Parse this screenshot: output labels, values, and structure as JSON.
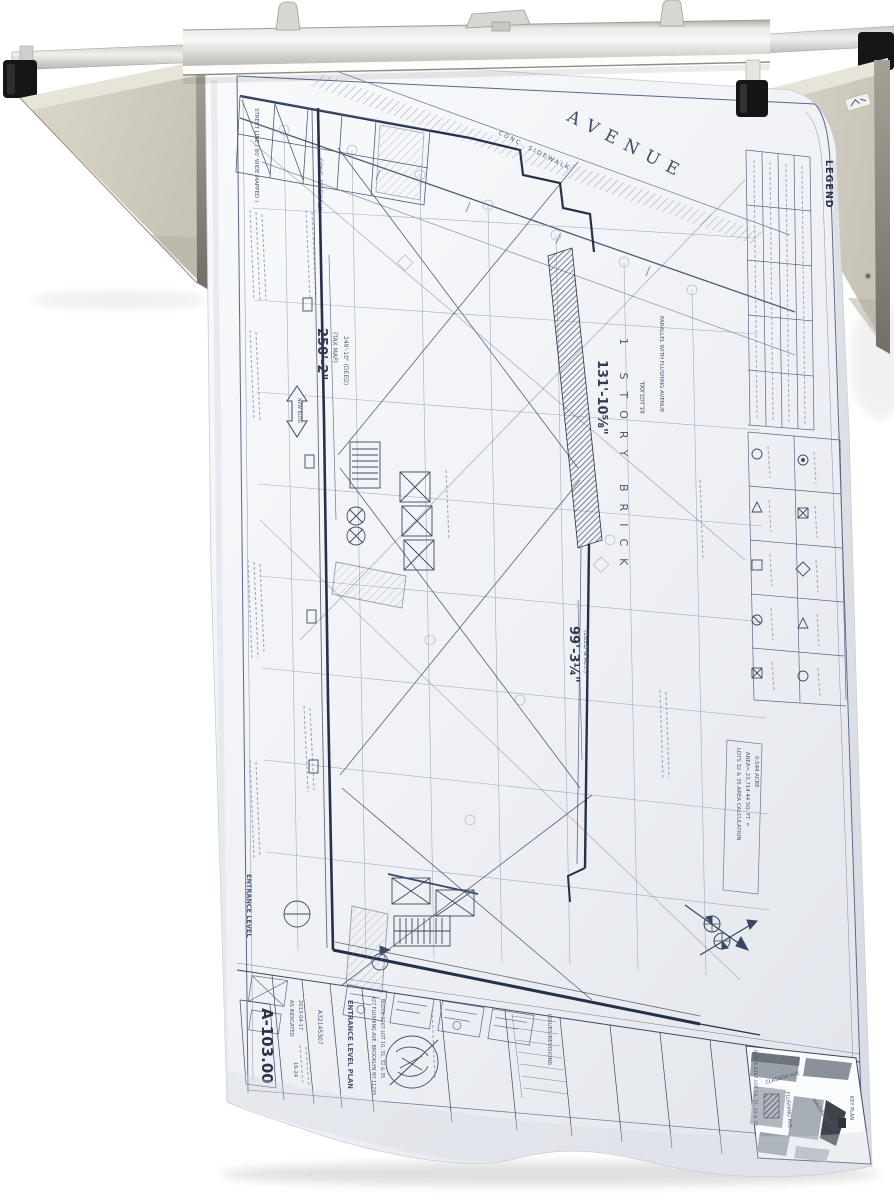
{
  "scene": {
    "background": "#ffffff"
  },
  "rack": {
    "name": "drop-lift-blueprint-wall-rack",
    "colors": {
      "bracket": "#cdc9bc",
      "rail": "#d9d9d6",
      "end_caps": "#161616",
      "clamp_bar": "#e8e8e5"
    }
  },
  "blueprint": {
    "paper_color": "#f2f4f7",
    "ink_color": "#425070",
    "street": {
      "avenue": "AVENUE",
      "conc_sidewalk": "CONC. SIDEWALK",
      "street_line": "STREET LINE ( 80' WIDE MAPPED )"
    },
    "dimensions": {
      "d250": "250'-2\"",
      "d250_note": "(TAX MAP)",
      "d249": "249'-10\" (DEED)",
      "d131": "131'-10⅝\"",
      "d99": "99'-3¼\"",
      "d99_note": "(DEED & ACT.)"
    },
    "labels": {
      "parallel_note": "PARALLEL WITH FLUSHING AVENUE",
      "tax_lot": "TAX LOT 14",
      "story_brick": "1 STORY BRICK",
      "new_bldg": "NEW BLDG",
      "entrance_level": "ENTRANCE LEVEL"
    },
    "legend": {
      "title": "LEGEND"
    },
    "area_note": {
      "line1": "LOTS 32 & 35 AREA CALCULATION",
      "line2": "AREA= 23,714.44 SQ. FT. =",
      "line3": "0.544 ACRE"
    },
    "title_block": {
      "sheet_number": "A-103.00",
      "scale": "AS INDICATED",
      "date": "2013-04-17",
      "sheet_index": "16-24",
      "job_number": "A32145307",
      "drawing_title": "ENTRANCE LEVEL PLAN",
      "address_line1": "427 FLUSHING AVE, BROOKLYN NY 11205",
      "address_line2": "BLOCK 2267 LOT 10, 31, 32 & 35",
      "revisions_label": "ISSUES/REVISIONS"
    },
    "key_plan": {
      "title": "KEY PLAN",
      "block_note": "BLOCK 2267 LOT 10, 31, 32 & 35",
      "streets": [
        "CLASSON AVE",
        "FLUSHING AVE",
        "WALLABOUT ST"
      ]
    }
  }
}
